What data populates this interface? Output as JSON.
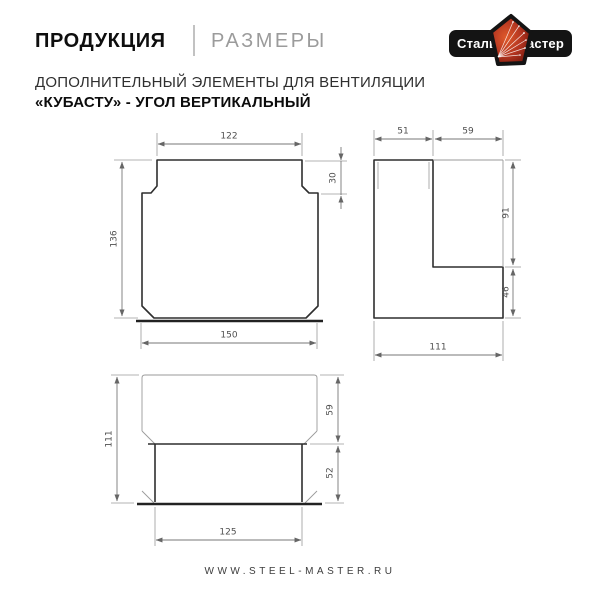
{
  "header": {
    "section": "ПРОДУКЦИЯ",
    "subsection": "РАЗМЕРЫ",
    "logo": {
      "word_left": "Сталь",
      "word_right": "Мастер",
      "bar_color": "#141414",
      "badge_color": "#b23420"
    }
  },
  "title": {
    "line1": "ДОПОЛНИТЕЛЬНЫЙ ЭЛЕМЕНТЫ ДЛЯ ВЕНТИЛЯЦИИ",
    "line2": "«КУБАСТУ» - УГОЛ ВЕРТИКАЛЬНЫЙ"
  },
  "drawings": {
    "front_view": {
      "dims": {
        "top_width": "122",
        "step_height": "30",
        "height": "136",
        "bottom_width": "150"
      }
    },
    "side_view": {
      "dims": {
        "top_left_width": "51",
        "top_right_width": "59",
        "right_upper_height": "91",
        "right_lower_height": "46",
        "bottom_width": "111"
      }
    },
    "top_view": {
      "dims": {
        "left_height": "111",
        "right_upper_height": "59",
        "right_lower_height": "52",
        "bottom_width": "125"
      }
    }
  },
  "footer": {
    "website": "WWW.STEEL-MASTER.RU"
  }
}
